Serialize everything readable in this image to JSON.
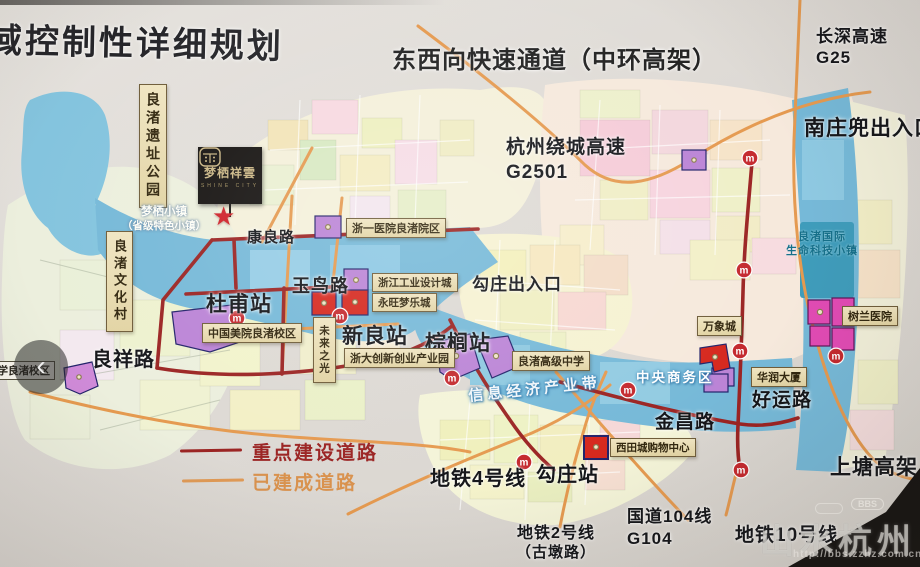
{
  "page": {
    "title": "域控制性详细规划",
    "subtitle": "东西向快速通道（中环高架）"
  },
  "highways": {
    "changshen": "长深高速",
    "changshen_code": "G25",
    "raocheng": "杭州绕城高速",
    "raocheng_code": "G2501",
    "shangtang": "上塘高架"
  },
  "interchanges": {
    "nanzhuangdou": "南庄兜出入口",
    "gouzhuang": "勾庄出入口"
  },
  "roads": {
    "kangliang": "康良路",
    "yuniao": "玉鸟路",
    "liangxiang": "良祥路",
    "haoyun": "好运路",
    "jinchang": "金昌路"
  },
  "stations": {
    "dufu": "杜甫站",
    "xinliang": "新良站",
    "zonglu": "棕榈站",
    "gouzhuang": "勾庄站"
  },
  "transit": {
    "line4": "地铁4号线",
    "line2": "地铁2号线",
    "line2_note": "（古墩路）",
    "line10": "地铁10号线",
    "g104_name": "国道104线",
    "g104_code": "G104"
  },
  "zones": {
    "heritage_park": "良渚遗址公园",
    "culture_village": "良渚文化村",
    "mengqi_town": "梦栖小镇",
    "mengqi_town_note": "（省级特色小镇）",
    "future_light": "未来之光",
    "info_belt": "信息经济产业带",
    "cbd": "中央商务区",
    "lifetech_1": "良渚国际",
    "lifetech_2": "生命科技小镇"
  },
  "places": {
    "meiyuan": "中国美院良渚校区",
    "zheyi": "浙一医院良渚院区",
    "design_city": "浙江工业设计城",
    "aeon": "永旺梦乐城",
    "zheda": "浙大创新创业产业园",
    "high_school": "良渚高级中学",
    "mixc": "万象城",
    "huarun": "华润大厦",
    "shulan": "树兰医院",
    "xitian": "西田城购物中心",
    "primary_school": "小学良渚校区"
  },
  "legend": {
    "key_roads": "重点建设道路",
    "built_roads": "已建成道路"
  },
  "logo": {
    "name": "梦栖祥雲",
    "tagline": "SHINE CITY"
  },
  "watermark": {
    "brand": "山水杭州",
    "badge": "BBS",
    "url": "http://bbs.zzhz.com.cn"
  },
  "icons": {
    "metro_glyph": "m",
    "back_chevron": "‹",
    "star": "★"
  },
  "colors": {
    "key_road": "#9b2423",
    "built_road": "#e09a56",
    "corridor_blue": "#76b9d8",
    "metro_red": "#c4292e",
    "label_box": "#e9ddb4"
  }
}
